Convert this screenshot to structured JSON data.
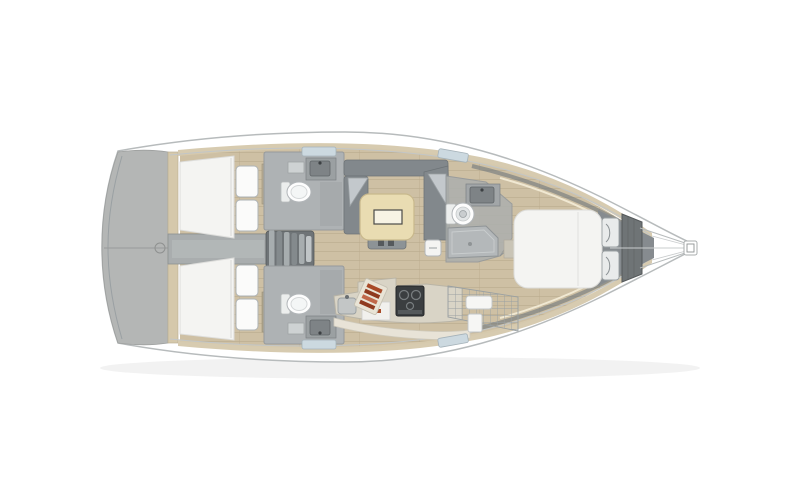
{
  "diagram": {
    "label": "sailboat-interior-floorplan-top-view",
    "regions": [
      {
        "id": "transom",
        "name": "stern-swim-platform"
      },
      {
        "id": "aft-cabin-top",
        "name": "aft-cabin-double-berth-port"
      },
      {
        "id": "aft-cabin-bottom",
        "name": "aft-cabin-double-berth-starboard"
      },
      {
        "id": "aft-head-top",
        "name": "aft-head-toilet-sink"
      },
      {
        "id": "aft-head-bottom",
        "name": "aft-head-toilet-sink"
      },
      {
        "id": "companionway",
        "name": "companionway-stairs"
      },
      {
        "id": "salon",
        "name": "salon-u-settee-and-table"
      },
      {
        "id": "galley",
        "name": "galley-stove-sink-counter"
      },
      {
        "id": "forward-head",
        "name": "forward-head-toilet-shower"
      },
      {
        "id": "forward-cabin",
        "name": "forward-island-berth"
      },
      {
        "id": "anchor-locker",
        "name": "anchor-locker"
      },
      {
        "id": "bowsprit",
        "name": "bowsprit-and-bow-fitting"
      }
    ],
    "fixtures": [
      "bed-icon",
      "pillow-icon",
      "toilet-icon",
      "sink-icon",
      "stove-icon",
      "table-icon",
      "sofa-icon",
      "stairs-icon",
      "shower-icon",
      "cutting-board-icon",
      "window-icon",
      "hatch-icon"
    ]
  },
  "colors": {
    "background": "#ffffff",
    "hull_white": "#ffffff",
    "hull_outline": "#b7bbbc",
    "transom_gray": "#b4b6b5",
    "bulkhead_beige": "#d5c8ab",
    "deck_beige": "#d6c9ad",
    "floor_wood": "#cec0a4",
    "floor_plank_line": "#b9aa8c",
    "corridor_gray": "#a9adae",
    "stairs_gray": "#6f7477",
    "bed_white": "#f4f4f2",
    "pillow_white": "#fbfbfa",
    "sofa_gray": "#82888c",
    "cushion_gray": "#c3c8cc",
    "table_beige": "#e9dcb2",
    "bath_floor_gray": "#aeb2b4",
    "fixture_white": "#fdfdfd",
    "sink_gray": "#7e8386",
    "stove_black": "#3b3e40",
    "anchor_locker_gray": "#6f7476",
    "bow_shadow_gray": "#868b8f",
    "window_blue": "#ccd9e0",
    "accent_red": "#a84a28",
    "accent_red_dark": "#8f3a1f"
  }
}
